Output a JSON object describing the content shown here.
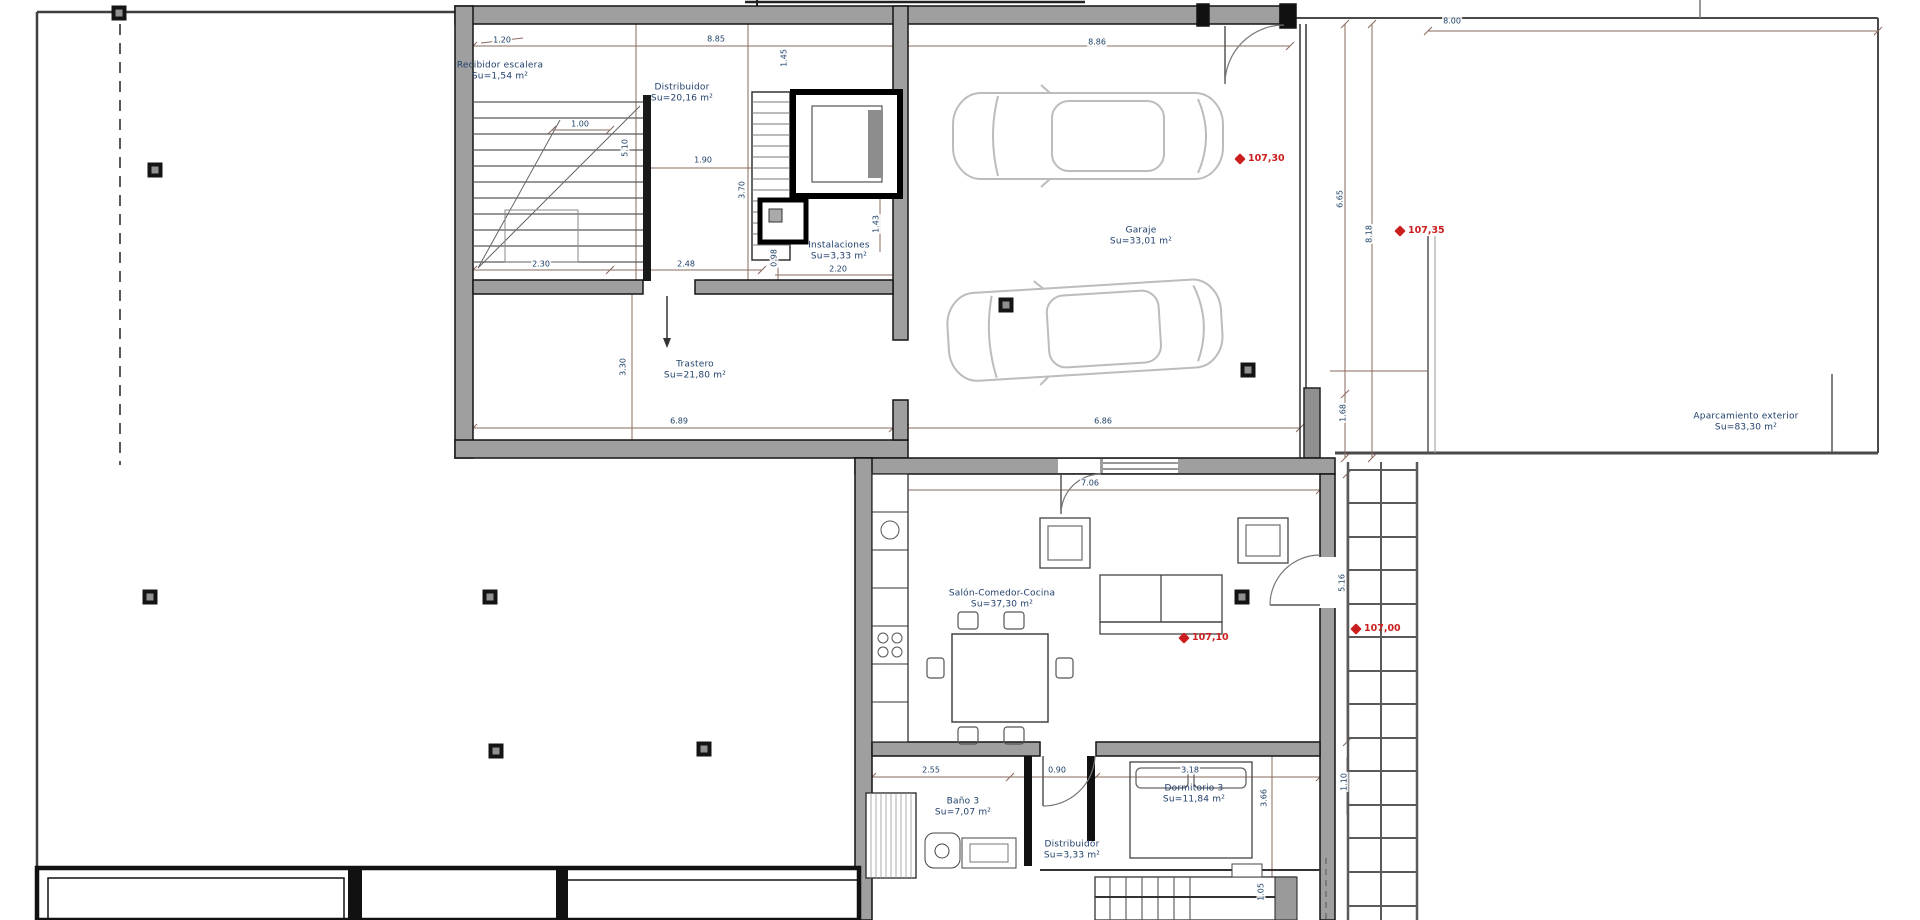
{
  "drawing": {
    "type": "architectural-floor-plan",
    "colors": {
      "dimension_line": "#8a6a5e",
      "dimension_text": "#1d4066",
      "label_text": "#21406b",
      "level_marker": "#cb1f1f",
      "wall_fill": "#9f9f9f",
      "wall_edge": "#141414"
    },
    "rooms": [
      {
        "name": "Recibidor escalera",
        "area": "Su=1,54 m²"
      },
      {
        "name": "Distribuidor",
        "area": "Su=20,16 m²"
      },
      {
        "name": "Instalaciones",
        "area": "Su=3,33 m²"
      },
      {
        "name": "Garaje",
        "area": "Su=33,01 m²"
      },
      {
        "name": "Trastero",
        "area": "Su=21,80 m²"
      },
      {
        "name": "Salón-Comedor-Cocina",
        "area": "Su=37,30 m²"
      },
      {
        "name": "Baño 3",
        "area": "Su=7,07 m²"
      },
      {
        "name": "Dormitorio 3",
        "area": "Su=11,84 m²"
      },
      {
        "name": "Distribuidor",
        "area": "Su=3,33 m²"
      },
      {
        "name": "Aparcamiento exterior",
        "area": "Su=83,30 m²"
      }
    ],
    "levels": [
      {
        "value": "107,30"
      },
      {
        "value": "107,35"
      },
      {
        "value": "107,10"
      },
      {
        "value": "107,00"
      }
    ],
    "dimensions": [
      {
        "t": "1.20"
      },
      {
        "t": "8.85"
      },
      {
        "t": "8.86"
      },
      {
        "t": "8.00"
      },
      {
        "t": "1.45"
      },
      {
        "t": "1.00"
      },
      {
        "t": "5.10"
      },
      {
        "t": "3.70"
      },
      {
        "t": "1.90"
      },
      {
        "t": "1.43"
      },
      {
        "t": "0.98"
      },
      {
        "t": "2.30"
      },
      {
        "t": "2.48"
      },
      {
        "t": "2.20"
      },
      {
        "t": "3.30"
      },
      {
        "t": "6.89"
      },
      {
        "t": "6.86"
      },
      {
        "t": "6.65"
      },
      {
        "t": "8.18"
      },
      {
        "t": "1.68"
      },
      {
        "t": "7.06"
      },
      {
        "t": "5.16"
      },
      {
        "t": "2.55"
      },
      {
        "t": "0.90"
      },
      {
        "t": "3.18"
      },
      {
        "t": "3.66"
      },
      {
        "t": "1.10"
      },
      {
        "t": "1.05"
      }
    ]
  }
}
